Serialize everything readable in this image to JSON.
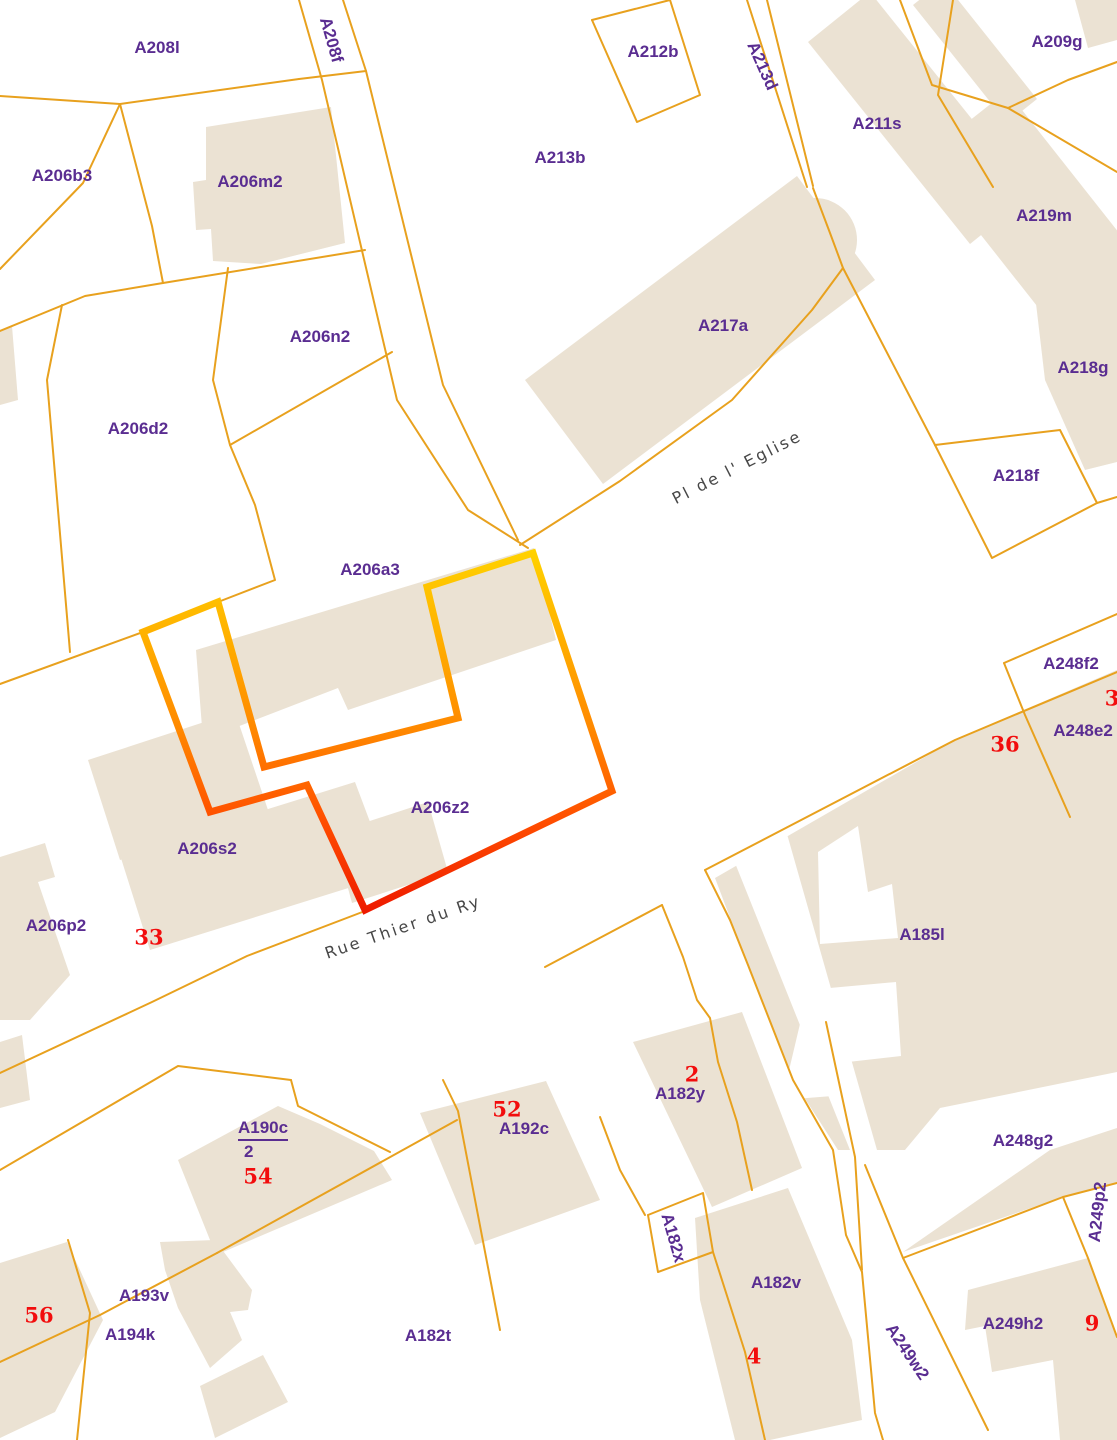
{
  "map": {
    "type": "cadastral-parcel-map",
    "selected_parcel": "A206z2",
    "parcel_labels": [
      {
        "text": "A208l",
        "x": 157,
        "y": 48,
        "rot": 0
      },
      {
        "text": "A208f",
        "x": 331,
        "y": 40,
        "rot": 74
      },
      {
        "text": "A206b3",
        "x": 62,
        "y": 176,
        "rot": 0
      },
      {
        "text": "A206m2",
        "x": 250,
        "y": 182,
        "rot": 0
      },
      {
        "text": "A206n2",
        "x": 320,
        "y": 337,
        "rot": 0
      },
      {
        "text": "A206d2",
        "x": 138,
        "y": 429,
        "rot": 0
      },
      {
        "text": "A206a3",
        "x": 370,
        "y": 570,
        "rot": 0
      },
      {
        "text": "A212b",
        "x": 653,
        "y": 52,
        "rot": 0
      },
      {
        "text": "A213b",
        "x": 560,
        "y": 158,
        "rot": 0
      },
      {
        "text": "A213d",
        "x": 762,
        "y": 66,
        "rot": 66
      },
      {
        "text": "A217a",
        "x": 723,
        "y": 326,
        "rot": 0
      },
      {
        "text": "A211s",
        "x": 877,
        "y": 124,
        "rot": 0
      },
      {
        "text": "A209g",
        "x": 1057,
        "y": 42,
        "rot": 0
      },
      {
        "text": "A219m",
        "x": 1044,
        "y": 216,
        "rot": 0
      },
      {
        "text": "A218g",
        "x": 1083,
        "y": 368,
        "rot": 0
      },
      {
        "text": "A218f",
        "x": 1016,
        "y": 476,
        "rot": 0
      },
      {
        "text": "A248f2",
        "x": 1071,
        "y": 664,
        "rot": 0
      },
      {
        "text": "A248e2",
        "x": 1083,
        "y": 731,
        "rot": 0
      },
      {
        "text": "A206z2",
        "x": 440,
        "y": 808,
        "rot": 0
      },
      {
        "text": "A206s2",
        "x": 207,
        "y": 849,
        "rot": 0
      },
      {
        "text": "A206p2",
        "x": 56,
        "y": 926,
        "rot": 0
      },
      {
        "text": "A185l",
        "x": 922,
        "y": 935,
        "rot": 0
      },
      {
        "text": "A192c",
        "x": 524,
        "y": 1129,
        "rot": 0
      },
      {
        "text": "A182y",
        "x": 680,
        "y": 1094,
        "rot": 0
      },
      {
        "text": "A248g2",
        "x": 1023,
        "y": 1141,
        "rot": 0
      },
      {
        "text": "A249p2",
        "x": 1098,
        "y": 1212,
        "rot": -84
      },
      {
        "text": "A182x",
        "x": 673,
        "y": 1238,
        "rot": 74
      },
      {
        "text": "A182v",
        "x": 776,
        "y": 1283,
        "rot": 0
      },
      {
        "text": "A193v",
        "x": 144,
        "y": 1296,
        "rot": 0
      },
      {
        "text": "A194k",
        "x": 130,
        "y": 1335,
        "rot": 0
      },
      {
        "text": "A182t",
        "x": 428,
        "y": 1336,
        "rot": 0
      },
      {
        "text": "A249w2",
        "x": 907,
        "y": 1352,
        "rot": 56
      },
      {
        "text": "A249h2",
        "x": 1013,
        "y": 1324,
        "rot": 0
      }
    ],
    "fraction_label": {
      "numerator": "A190c",
      "denominator": "2",
      "x": 238,
      "y": 1118
    },
    "house_numbers": [
      {
        "text": "33",
        "x": 149,
        "y": 937
      },
      {
        "text": "36",
        "x": 1005,
        "y": 744
      },
      {
        "text": "3",
        "x": 1112,
        "y": 698
      },
      {
        "text": "2",
        "x": 692,
        "y": 1074
      },
      {
        "text": "52",
        "x": 507,
        "y": 1109
      },
      {
        "text": "54",
        "x": 258,
        "y": 1176
      },
      {
        "text": "56",
        "x": 39,
        "y": 1315
      },
      {
        "text": "4",
        "x": 754,
        "y": 1356
      },
      {
        "text": "9",
        "x": 1092,
        "y": 1323
      }
    ],
    "street_labels": [
      {
        "text": "Rue Thier du Ry",
        "x": 403,
        "y": 927,
        "rot": -19
      },
      {
        "text": "Pl de l' Eglise",
        "x": 737,
        "y": 467,
        "rot": -27
      }
    ]
  },
  "colors": {
    "background": "#ffffff",
    "building": "#EBE2D3",
    "boundary": "#E8A11E",
    "label": "#5A2D91",
    "number": "#F20D0D",
    "street_label": "#474747",
    "selection_gradient": [
      "#FFD400",
      "#FFB000",
      "#FF8800",
      "#FF4D00",
      "#ED1800"
    ]
  },
  "geometry": {
    "buildings": [
      {
        "points": "206,127 331,107 345,243 261,264 213,261 211,229 196,230 193,182 206,180"
      },
      {
        "points": "797,176 875,280 603,484 525,380"
      },
      {
        "points": "870,-8 1032,194 970,244 808,42"
      },
      {
        "points": "1007,91 1149,271 1063,339 921,159"
      },
      {
        "points": "943,-19 1037,99 1007,123 913,5"
      },
      {
        "points": "1075,0 1117,0 1117,40 1088,48"
      },
      {
        "points": "1035,295 1105,272 1117,278 1117,462 1085,470 1045,380"
      },
      {
        "points": "0,330 12,326 18,400 0,405"
      },
      {
        "points": "88,760 235,712 268,810 120,860"
      },
      {
        "points": "120,855 355,782 390,875 150,950"
      },
      {
        "points": "0,857 45,843 55,877 38,882 70,975 30,1020 0,1020"
      },
      {
        "points": "196,650 534,548 556,640 348,710 338,688 203,740"
      },
      {
        "points": "333,833 428,802 448,872 352,903"
      },
      {
        "points": "633,1042 742,1012 802,1168 712,1207"
      },
      {
        "points": "695,1218 788,1188 852,1340 862,1420 770,1440 735,1440 700,1300"
      },
      {
        "points": "420,1113 546,1081 600,1200 475,1245"
      },
      {
        "points": "278,1106 320,1124 374,1151 392,1180 216,1255 178,1160"
      },
      {
        "points": "160,1242 215,1240 252,1290 248,1310 230,1312 242,1340 210,1368 178,1308 165,1270"
      },
      {
        "points": "200,1386 263,1355 288,1402 215,1438"
      },
      {
        "points": "0,1263 67,1242 103,1320 55,1412 0,1438"
      },
      {
        "points": "715,878 958,738 1117,670 1117,1072 940,1108 905,1150 838,1150 793,1080 748,965"
      },
      {
        "points": "968,1290 1088,1258 1117,1337 1117,1440 1060,1440 1053,1360 992,1372 985,1326 965,1330"
      },
      {
        "points": "903,1252 1050,1150 1117,1128 1117,1183 1063,1197"
      },
      {
        "points": "0,1042 22,1035 30,1100 0,1108"
      }
    ],
    "building_circles": [
      {
        "cx": 815,
        "cy": 240,
        "r": 42
      }
    ],
    "white_cutouts": [
      {
        "points": "818,852 858,826 868,892 892,884 898,938 820,944"
      },
      {
        "points": "723,833 783,820 877,1150 850,1150"
      },
      {
        "points": "808,990 896,982 901,1056 848,1062 845,1095 782,1100"
      }
    ],
    "boundary_lines": [
      {
        "points": "0,96 120,104 299,79"
      },
      {
        "points": "299,0 322,80 397,400 468,510 528,548"
      },
      {
        "points": "343,0 366,71 443,385 518,540"
      },
      {
        "points": "299,79 366,71"
      },
      {
        "points": "120,104 83,183 0,269"
      },
      {
        "points": "120,104 152,226 163,283"
      },
      {
        "points": "163,283 85,296 0,331"
      },
      {
        "points": "62,305 47,380 70,652"
      },
      {
        "points": "163,283 365,250"
      },
      {
        "points": "228,268 213,380 230,445 255,505 275,580 218,602"
      },
      {
        "points": "230,445 392,352"
      },
      {
        "points": "592,20 670,0"
      },
      {
        "points": "592,20 637,122 700,95 670,0"
      },
      {
        "points": "747,0 807,187"
      },
      {
        "points": "767,0 813,186"
      },
      {
        "points": "813,188 830,233 843,268 935,445"
      },
      {
        "points": "520,545 620,481 732,400 812,310 843,268"
      },
      {
        "points": "900,0 932,85 1008,108"
      },
      {
        "points": "1008,108 1068,80 1117,62"
      },
      {
        "points": "1008,108 1117,172"
      },
      {
        "points": "935,445 1060,430 1097,503 992,558 935,445"
      },
      {
        "points": "1097,503 1117,497"
      },
      {
        "points": "1004,663 1117,614"
      },
      {
        "points": "1004,663 1025,715 1070,817"
      },
      {
        "points": "705,870 955,740 1117,672"
      },
      {
        "points": "705,870 730,920 748,965 793,1080 833,1150 846,1235 862,1272"
      },
      {
        "points": "862,1272 875,1413 883,1440"
      },
      {
        "points": "953,0 938,95 993,187"
      },
      {
        "points": "865,1165 903,1258 988,1430"
      },
      {
        "points": "903,1258 1063,1197 1117,1183"
      },
      {
        "points": "1063,1197 1088,1258 1117,1337"
      },
      {
        "points": "0,1073 152,1002 247,956 365,911"
      },
      {
        "points": "0,1170 178,1066 291,1080"
      },
      {
        "points": "291,1080 298,1106 390,1152"
      },
      {
        "points": "217,1253 457,1120"
      },
      {
        "points": "217,1253 100,1315 0,1362"
      },
      {
        "points": "68,1240 90,1313 77,1440"
      },
      {
        "points": "443,1080 458,1111 500,1330"
      },
      {
        "points": "545,967 662,905"
      },
      {
        "points": "662,905 683,957 697,1000 710,1018 718,1062 737,1122 752,1190"
      },
      {
        "points": "600,1117 620,1170 645,1215"
      },
      {
        "points": "648,1215 703,1193 713,1252 658,1272 648,1215"
      },
      {
        "points": "713,1252 745,1352 765,1440"
      },
      {
        "points": "826,1022 855,1157 862,1270"
      },
      {
        "points": "0,684 143,632 218,602"
      }
    ],
    "selection_outline": {
      "points": "143,632 218,602 264,767 458,718 427,587 533,553 612,791 365,910 307,785 210,812",
      "gradient_y1": 545,
      "gradient_y2": 915,
      "stroke_width": 7
    }
  }
}
